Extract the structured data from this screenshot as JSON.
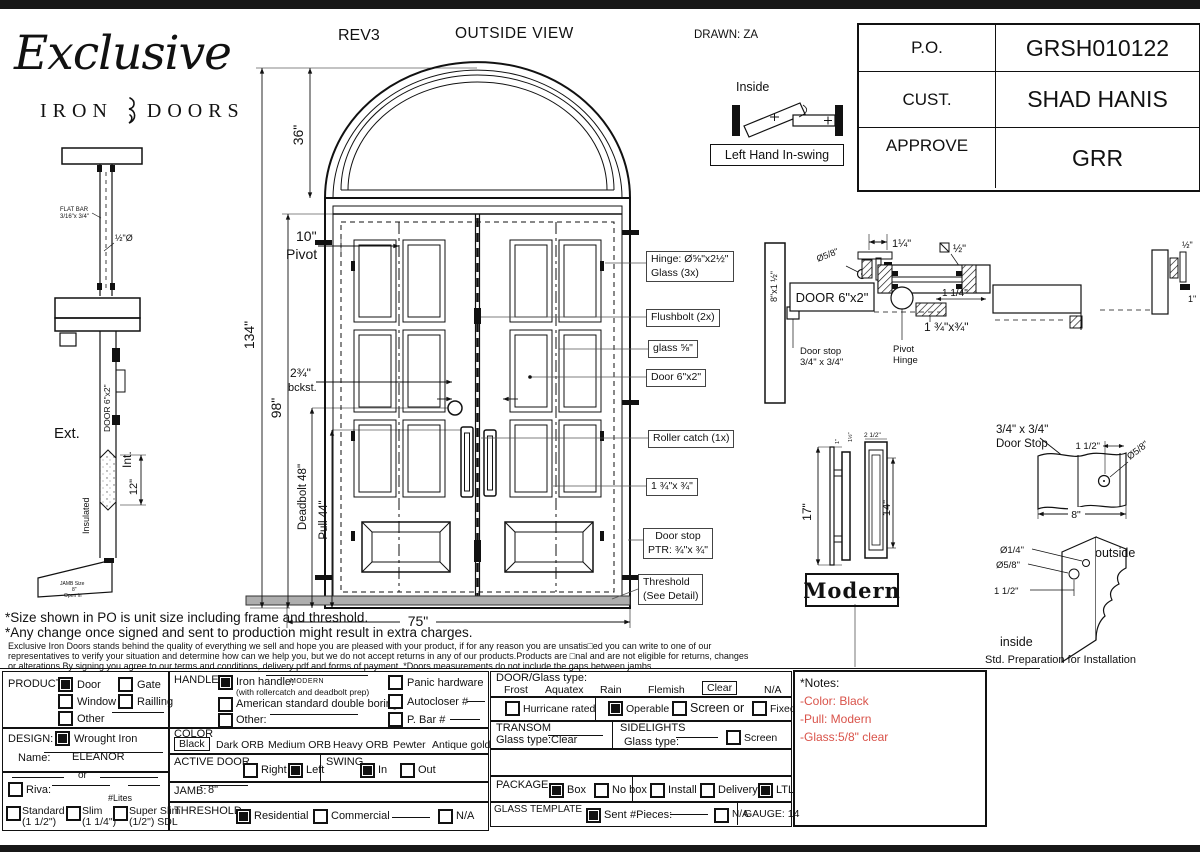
{
  "header": {
    "logo_script": "Exclusive",
    "logo_iron": "IRON",
    "logo_doors": "DOORS",
    "rev": "REV3",
    "view_title": "OUTSIDE VIEW",
    "drawn_by": "DRAWN: ZA"
  },
  "order_table": {
    "rows": [
      {
        "label": "P.O.",
        "value": "GRSH010122"
      },
      {
        "label": "CUST.",
        "value": "SHAD HANIS"
      },
      {
        "label": "APPROVE",
        "value": "GRR"
      }
    ]
  },
  "swing": {
    "inside": "Inside",
    "caption": "Left Hand In-swing"
  },
  "elev": {
    "d134": "134\"",
    "d36": "36\"",
    "d98": "98\"",
    "d10": "10\"",
    "pivot": "Pivot",
    "backset": "2¾\"",
    "bckst": "bckst.",
    "deadbolt": "Deadbolt 48\"",
    "pull": "Pull 44\"",
    "d75": "75\"",
    "c_hinge1": "Hinge: Ø⅝\"x2½\"",
    "c_hinge2": "Glass (3x)",
    "c_flush": "Flushbolt (2x)",
    "c_glass": "glass ⅝\"",
    "c_door": "Door  6\"x2\"",
    "c_roller": "Roller catch  (1x)",
    "c_134": "1 ¾\"x ¾\"",
    "c_stop1": "Door stop",
    "c_stop2": "PTR:  ¾\"x ¾\"",
    "c_thr1": "Threshold",
    "c_thr2": "(See Detail)"
  },
  "lsec": {
    "flatbar1": "FLAT BAR",
    "flatbar2": "3/16\"x 3/4\"",
    "halfdia": "½\"Ø",
    "ext": "Ext.",
    "int": "Int.",
    "door": "DOOR 6\"x2\"",
    "insulated": "Insulated",
    "d12": "12\"",
    "jamb1": "JAMB Size",
    "jamb2": "8\"",
    "jamb3": "Open in"
  },
  "rsec": {
    "jamb": "8\"x1 ½\"",
    "dia58": "Ø5/8\"",
    "d114": "1¼\"",
    "sq12": "½\"",
    "door": "DOOR 6\"x2\"",
    "d114b": "1 1/4\"",
    "d134": "1 ¾\"x¾\"",
    "ph1": "Pivot",
    "ph2": "Hinge",
    "ds1": "Door stop",
    "ds2": "3/4\" x 3/4\"",
    "e12": "½\"",
    "e1": "1\""
  },
  "handle": {
    "d17": "17\"",
    "d14": "14\"",
    "d212": "2 1/2\"",
    "d1": "1\"",
    "d112": "1½\"",
    "name": "Modern"
  },
  "stop": {
    "t1": "3/4\" x 3/4\"",
    "t2": "Door Stop",
    "d112": "1 1/2\"",
    "dia58": "Ø5/8\"",
    "d8": "8\"",
    "dia14": "Ø1/4\"",
    "dia58b": "Ø5/8\"",
    "d112b": "1 1/2\"",
    "outside": "outside",
    "inside": "inside",
    "caption": "Std. Preparation for Installation"
  },
  "disc": {
    "l1": "*Size shown in PO is unit size including frame and threshold.",
    "l2": "*Any change once signed and sent to production might result in extra charges.",
    "s1": "Exclusive Iron Doors stands behind the quality of everything we sell and hope you are pleased with your product, if for any reason you are unsatis□ed you can write to one of our",
    "s2": "representatives to verify your situation and determine how can we help you, but we do not accept returns in any of our products.Products are □nal and are not eligible for returns, changes",
    "s3": "or alterations.By signing you agree to our terms and conditions, delivery pdf and forms of payment. *Doors measurements do not include the gaps between jambs"
  },
  "form": {
    "product": {
      "label": "PRODUCT:",
      "door": "Door",
      "gate": "Gate",
      "window": "Window",
      "railling": "Railling",
      "other": "Other"
    },
    "design": {
      "label": "DESIGN:",
      "wrought": "Wrought Iron",
      "name_label": "Name:",
      "name_value": "ELEANOR",
      "or": "or"
    },
    "riva": {
      "label": "Riva:",
      "lites": "#Lites",
      "std": "Standard",
      "std2": "(1 1/2\")",
      "slim": "Slim",
      "slim2": "(1 1/4\")",
      "super": "Super Slim",
      "super2": "(1/2\") SDL"
    },
    "handle": {
      "label": "HANDLE",
      "iron": "Iron handle:",
      "iron_val": "MODERN",
      "note": "(with rollercatch and deadbolt prep)",
      "american": "American standard double boring",
      "other": "Other:",
      "panic": "Panic hardware",
      "auto": "Autocloser #",
      "pbar": "P. Bar #"
    },
    "color": {
      "label": "COLOR",
      "o0": "Black",
      "o1": "Dark ORB",
      "o2": "Medium ORB",
      "o3": "Heavy ORB",
      "o4": "Pewter",
      "o5": "Antique gold"
    },
    "active": {
      "label": "ACTIVE DOOR",
      "right": "Right",
      "left": "Left"
    },
    "swing": {
      "label": "SWING",
      "in": "In",
      "out": "Out"
    },
    "jamb": {
      "label": "JAMB:",
      "value": "8\""
    },
    "threshold": {
      "label": "THRESHOLD",
      "res": "Residential",
      "com": "Commercial",
      "na": "N/A"
    },
    "doorglass": {
      "label": "DOOR/Glass type:",
      "o0": "Frost",
      "o1": "Aquatex",
      "o2": "Rain",
      "o3": "Flemish",
      "o4": "Clear",
      "o5": "N/A"
    },
    "hurr": {
      "label": "Hurricane rated",
      "operable": "Operable",
      "screen": "Screen or",
      "fixed": "Fixed"
    },
    "transom": {
      "label": "TRANSOM",
      "glass": "Glass type:",
      "value": "Clear"
    },
    "side": {
      "label": "SIDELIGHTS",
      "glass": "Glass type:",
      "screen": "Screen"
    },
    "package": {
      "label": "PACKAGE",
      "box": "Box",
      "nobox": "No box",
      "install": "Install",
      "delivery": "Delivery",
      "ltl": "LTL"
    },
    "template": {
      "label": "GLASS TEMPLATE",
      "sent": "Sent",
      "pieces": "#Pieces:",
      "na": "N/A",
      "gauge": "GAUGE: 14"
    },
    "notes": {
      "title": "*Notes:",
      "n0": "-Color: Black",
      "n1": "-Pull: Modern",
      "n2": "-Glass:5/8\"  clear"
    },
    "checked": {
      "product_door": true,
      "design_wrought": true,
      "handle_iron": true,
      "active_left": true,
      "swing_in": true,
      "threshold_res": true,
      "operable": true,
      "package_box": true,
      "package_ltl": true,
      "template_sent": true
    }
  }
}
